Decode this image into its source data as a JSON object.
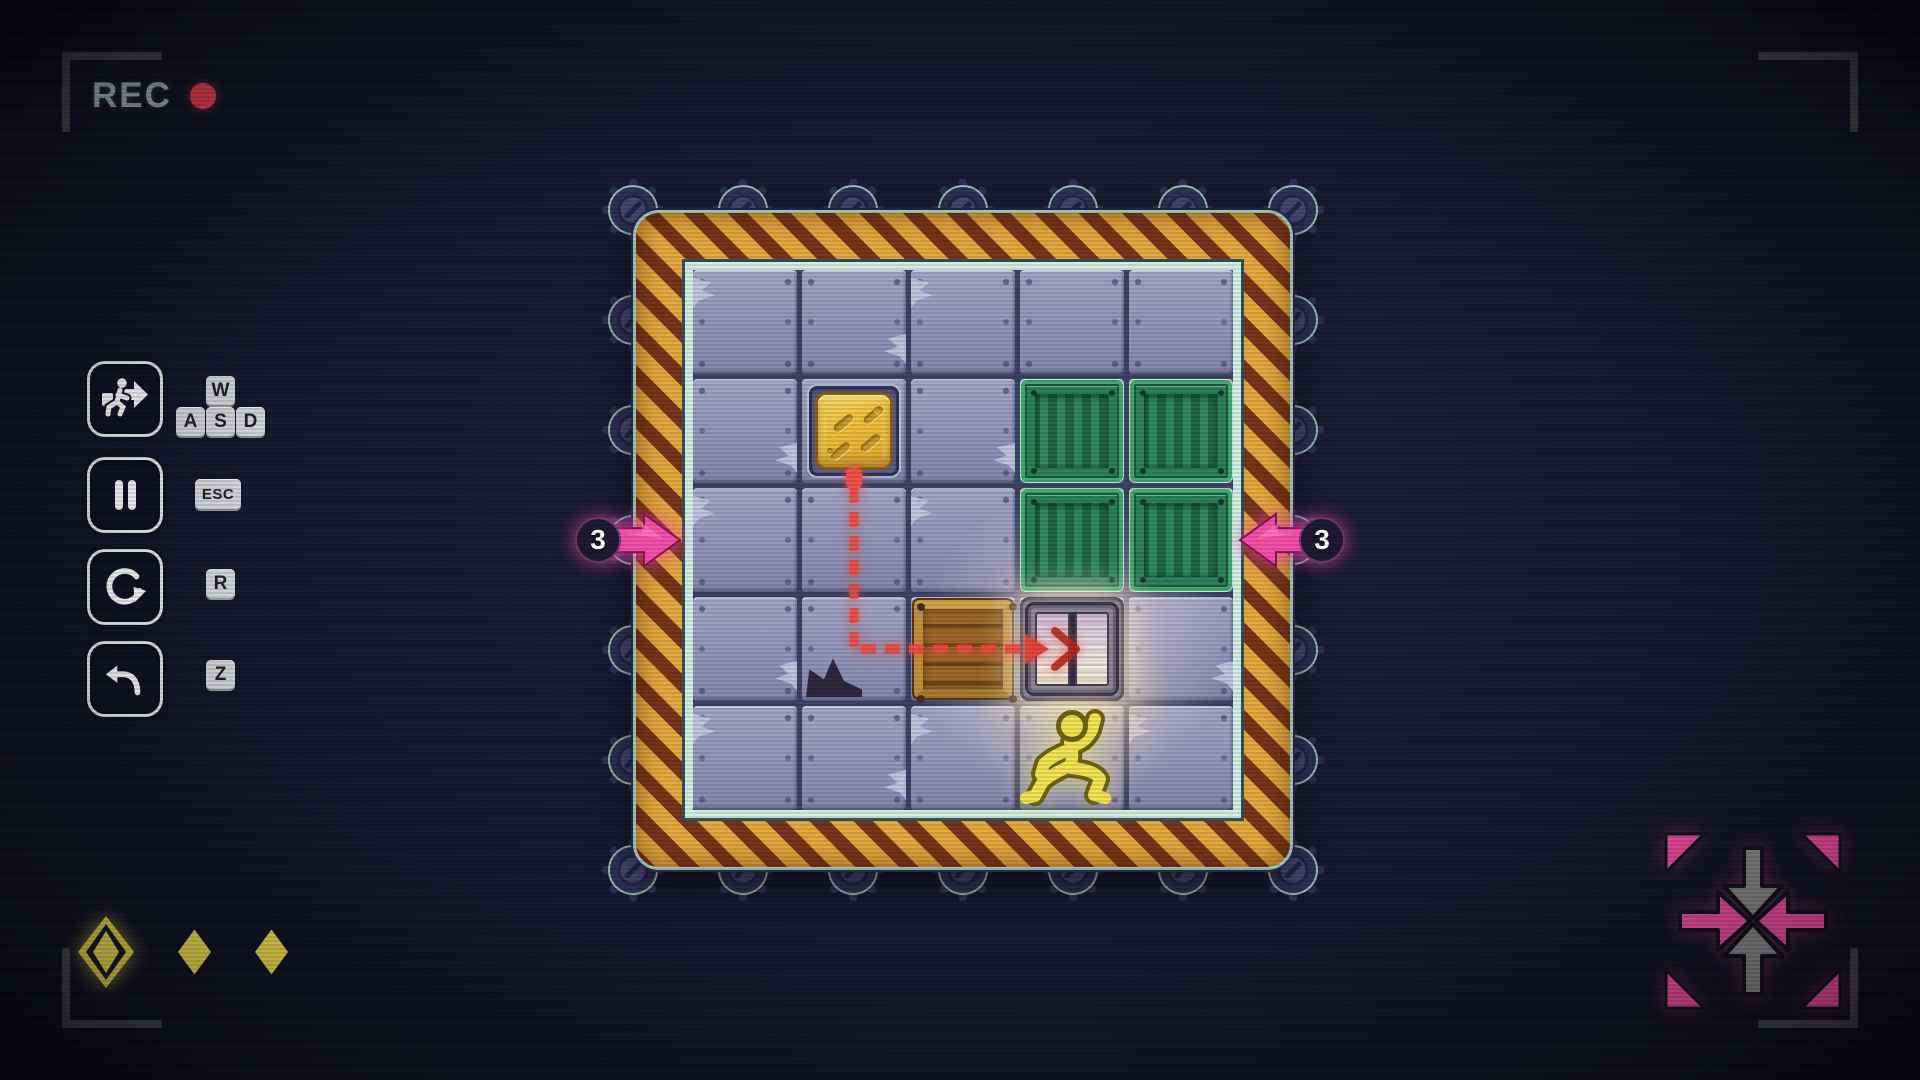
{
  "recorder": {
    "label": "REC",
    "dot_color": "#f2405c"
  },
  "controls": {
    "move": {
      "action": "move",
      "icon": "runner-arrow-icon",
      "keys": {
        "w": "W",
        "a": "A",
        "s": "S",
        "d": "D"
      }
    },
    "pause": {
      "action": "pause",
      "icon": "pause-icon",
      "key": "ESC"
    },
    "restart": {
      "action": "restart",
      "icon": "restart-icon",
      "key": "R"
    },
    "undo": {
      "action": "undo",
      "icon": "undo-icon",
      "key": "Z"
    }
  },
  "board": {
    "rows": 5,
    "cols": 5,
    "counters": {
      "left": "3",
      "right": "3"
    },
    "entities": [
      {
        "type": "pressure-pad",
        "row": 1,
        "col": 1
      },
      {
        "type": "green-crate",
        "row": 1,
        "col": 3
      },
      {
        "type": "green-crate",
        "row": 1,
        "col": 4
      },
      {
        "type": "green-crate",
        "row": 2,
        "col": 3
      },
      {
        "type": "green-crate",
        "row": 2,
        "col": 4
      },
      {
        "type": "wooden-crate",
        "row": 3,
        "col": 2
      },
      {
        "type": "door",
        "row": 3,
        "col": 3
      },
      {
        "type": "player",
        "row": 4,
        "col": 3
      }
    ],
    "wire_path": {
      "from_cell": [
        1,
        1
      ],
      "corner_cell": [
        3,
        1
      ],
      "to_cell": [
        3,
        3
      ]
    },
    "wear_cells": [
      [
        0,
        0
      ],
      [
        0,
        1
      ],
      [
        0,
        2
      ],
      [
        1,
        0
      ],
      [
        1,
        2
      ],
      [
        2,
        0
      ],
      [
        2,
        2
      ],
      [
        3,
        0
      ],
      [
        4,
        0
      ],
      [
        4,
        1
      ],
      [
        4,
        2
      ],
      [
        3,
        4
      ],
      [
        4,
        4
      ]
    ],
    "torn_cells": [
      [
        3,
        1
      ]
    ]
  },
  "gems": {
    "slots": [
      {
        "state": "highlighted"
      },
      {
        "state": "filled"
      },
      {
        "state": "filled"
      }
    ]
  },
  "colors": {
    "accent_pink": "#f64fa8",
    "gem_yellow": "#f7e554",
    "path_red": "#ee4a40",
    "crate_green": "#2f8a5a",
    "hazard_yellow": "#e7a93c",
    "rec_red": "#f2405c",
    "rec_text": "#a9bfc6"
  }
}
